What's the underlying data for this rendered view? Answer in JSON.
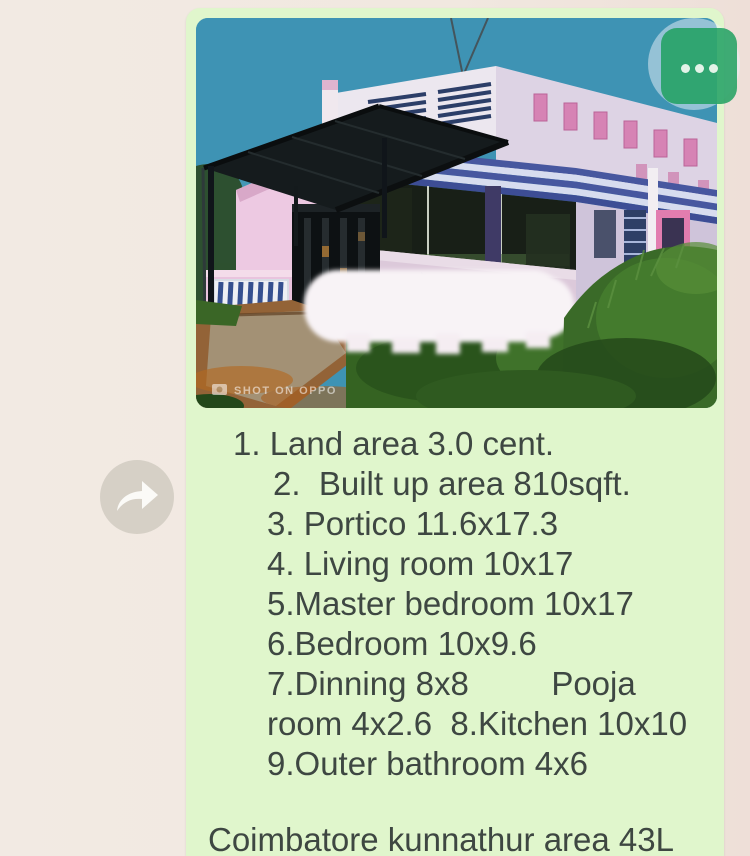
{
  "colors": {
    "chat_background": "#f1e8e0",
    "bubble_green": "#e0f6cc",
    "more_button_green": "#1ea05e",
    "forward_circle_gray": "#d6d0c6",
    "text_dark": "#3e4742"
  },
  "icons": {
    "forward": "forward-arrow-icon",
    "more": "more-dots-icon",
    "watermark_camera": "camera-icon"
  },
  "photo": {
    "watermark": "SHOT ON OPPO",
    "subject": "pink single-storey house with black canopy, gate and greenery"
  },
  "message": {
    "lines": [
      "1. Land area 3.0 cent.",
      "2.  Built up area 810sqft.",
      "3. Portico 11.6x17.3",
      "4. Living room 10x17",
      "5.Master bedroom 10x17",
      "6.Bedroom 10x9.6",
      "7.Dinning 8x8         Pooja",
      "room 4x2.6  8.Kitchen 10x10",
      "9.Outer bathroom 4x6"
    ],
    "footer": "Coimbatore kunnathur area 43L"
  }
}
